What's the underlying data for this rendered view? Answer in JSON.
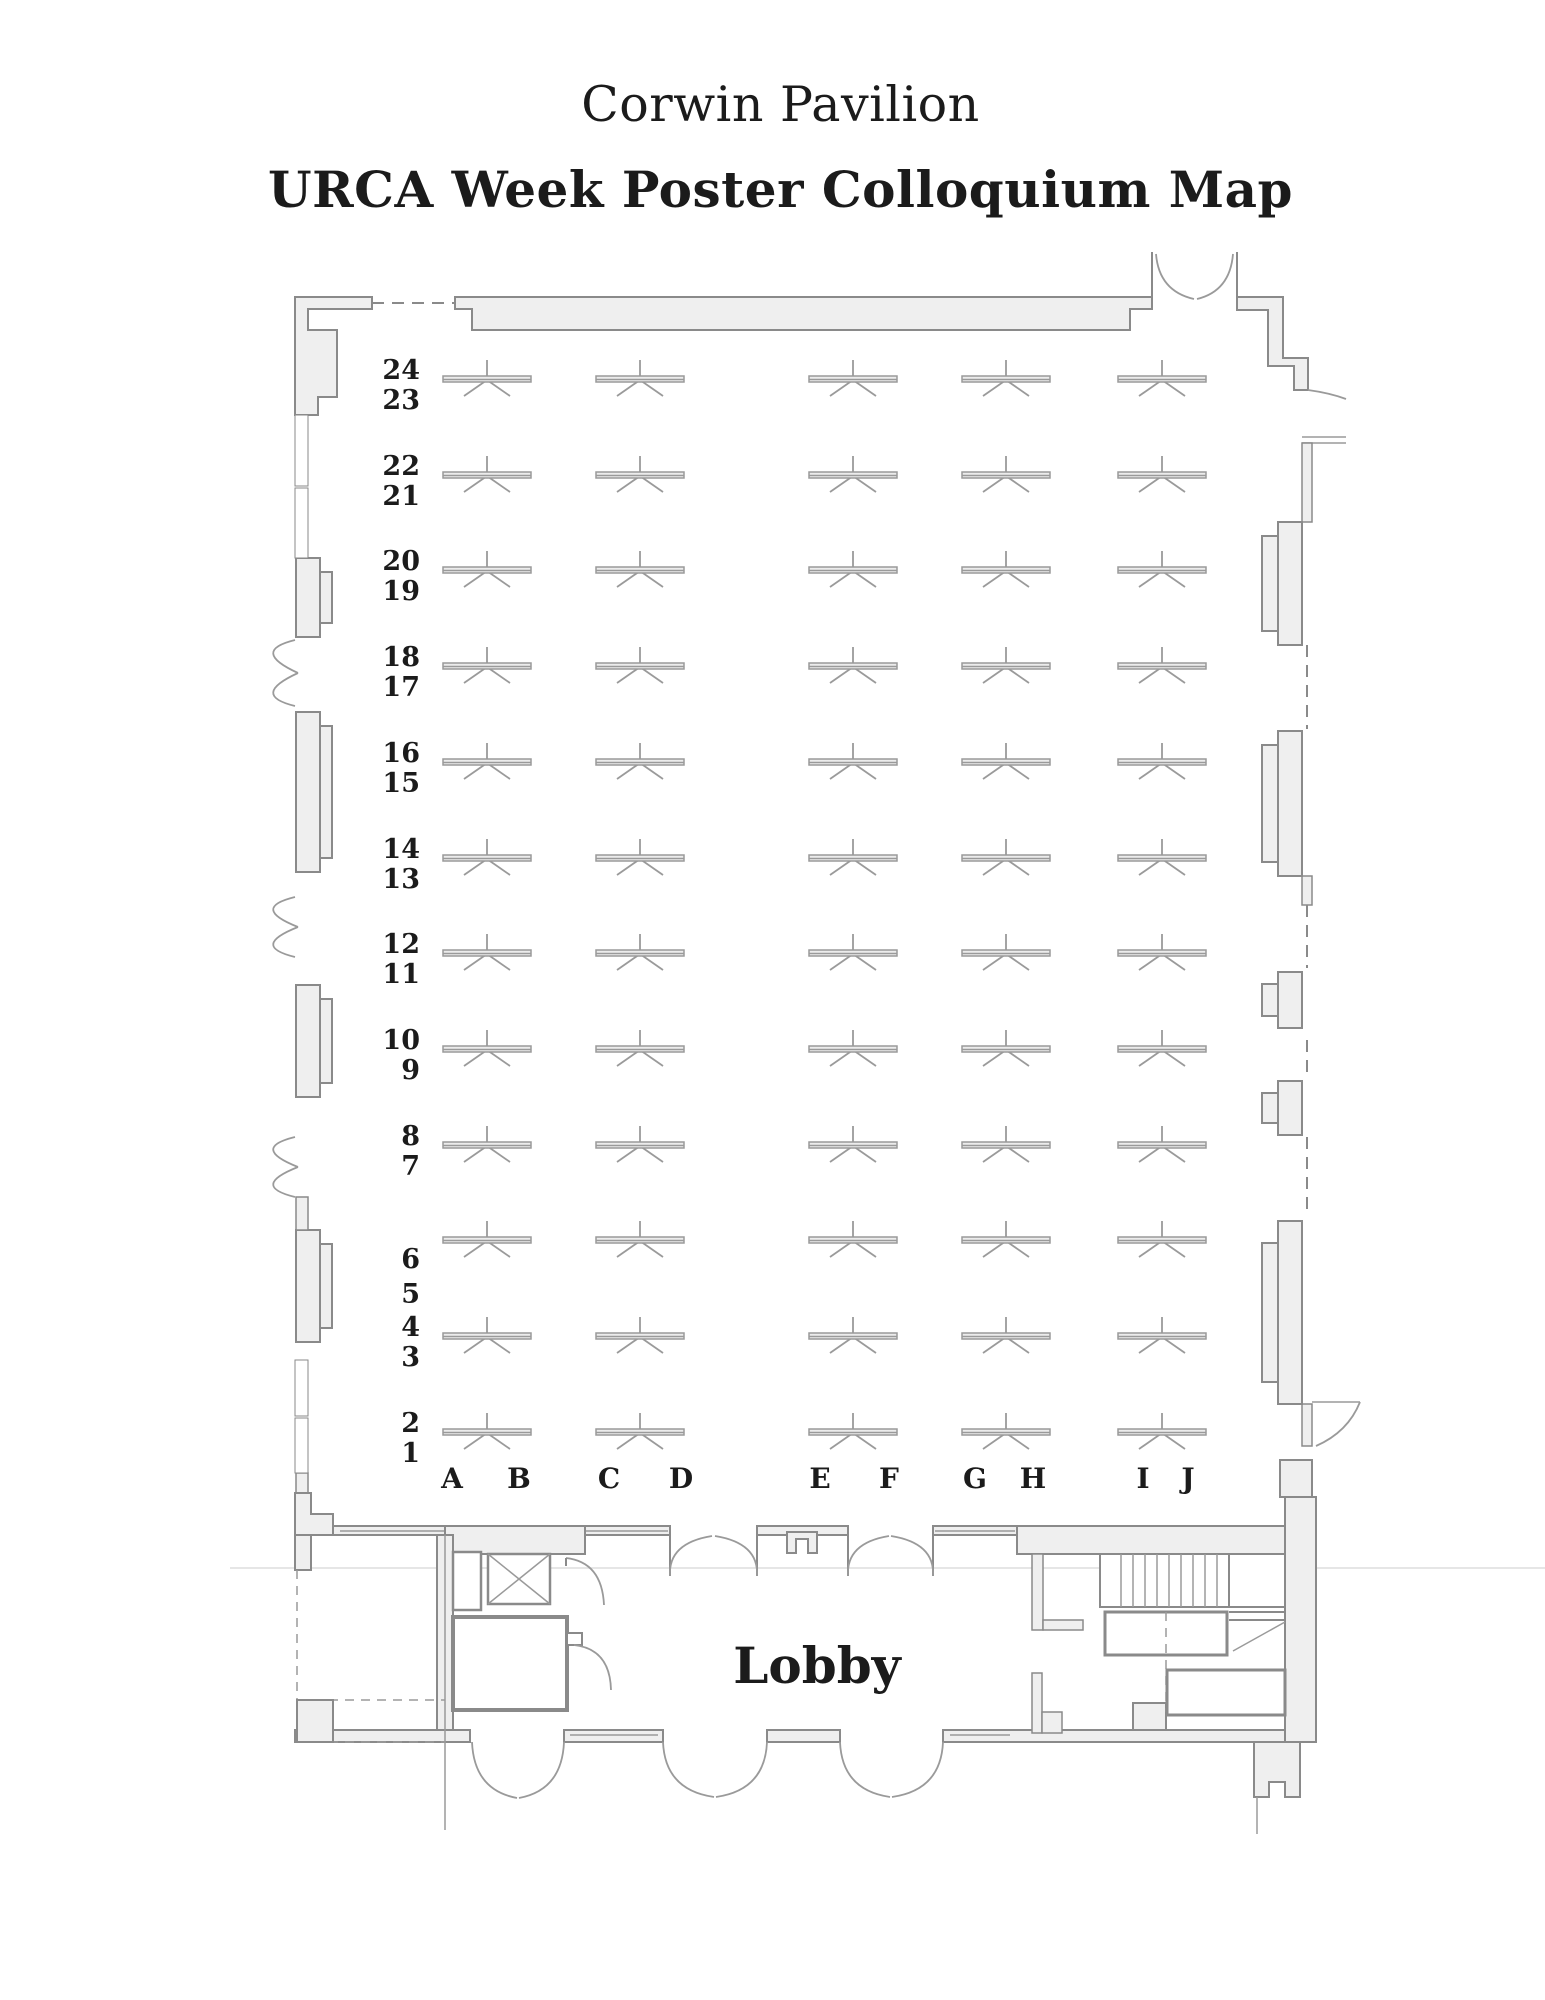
{
  "title": {
    "venue": "Corwin Pavilion",
    "map_title": "URCA Week Poster Colloquium Map"
  },
  "labels": {
    "lobby": "Lobby"
  },
  "rows": [
    [
      "24",
      "23"
    ],
    [
      "22",
      "21"
    ],
    [
      "20",
      "19"
    ],
    [
      "18",
      "17"
    ],
    [
      "16",
      "15"
    ],
    [
      "14",
      "13"
    ],
    [
      "12",
      "11"
    ],
    [
      "10",
      "9"
    ],
    [
      "8",
      "7"
    ],
    [
      "6",
      "5"
    ],
    [
      "4",
      "3"
    ],
    [
      "2",
      "1"
    ]
  ],
  "columns": [
    "A",
    "B",
    "C",
    "D",
    "E",
    "F",
    "G",
    "H",
    "I",
    "J"
  ],
  "grid": {
    "row_count": 12,
    "tables_per_row": 5,
    "total_tables": 60
  },
  "colors": {
    "wall_fill": "#efefef",
    "wall_stroke": "#8a8a8a",
    "table_stroke": "#a0a0a0",
    "text": "#1b1b1b"
  }
}
